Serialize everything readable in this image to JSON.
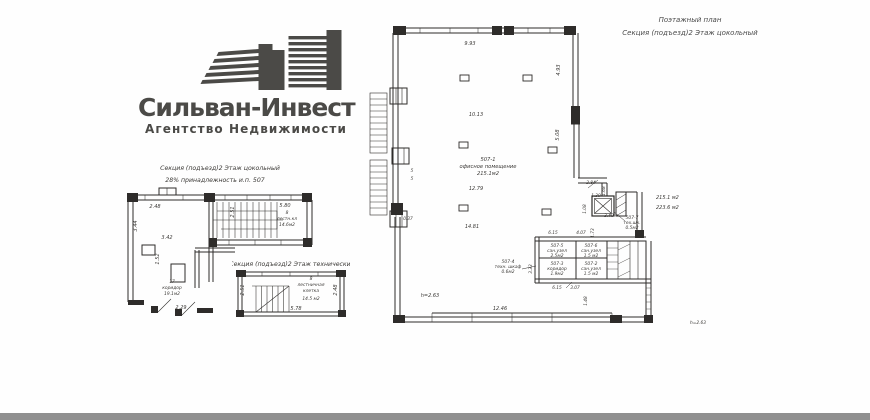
{
  "logo": {
    "title": "Сильван-Инвест",
    "subtitle": "Агентство Недвижимости"
  },
  "sheet_title": {
    "line1": "Поэтажный план",
    "line2": "Секция (подъезд)2  Этаж цокольный"
  },
  "plan_basement": {
    "header1": "Секция (подъезд)2  Этаж цокольный",
    "header2": "28% принадлежность и.п. 507",
    "stair_num": "8",
    "stair_name": "лестн.кл",
    "stair_area": "14.6м2",
    "corridor_num": "17",
    "corridor_name": "коридор",
    "corridor_area": "19.1м2",
    "d_248": "2.48",
    "d_251": "2.51",
    "d_580": "5.80",
    "d_344": "3.44",
    "d_342": "3.42",
    "d_152": "1.52",
    "d_229": "2.29"
  },
  "plan_technical": {
    "header": "Секция (подъезд)2  Этаж технический",
    "room_num": "8",
    "room_name1": "лестничная",
    "room_name2": "клетка",
    "room_area": "14.5 м2",
    "d_251": "2.51",
    "d_248": "2.48",
    "d_578": "5.78"
  },
  "plan_main": {
    "office_num": "507-1",
    "office_name": "офисное помещение",
    "office_area": "215.1м2",
    "note_area1": "215.1 м2",
    "note_area2": "223.6 м2",
    "r507_7_num": "507-7",
    "r507_7_name": "тех.шк.",
    "r507_7_area": "0.5м2",
    "r507_4_num": "507-4",
    "r507_4_name": "техн. шкаф",
    "r507_4_area": "0.6м2",
    "r507_5_num": "507-5",
    "r507_5_name": "сан.узел",
    "r507_5_area": "2.5м2",
    "r507_6_num": "507-6",
    "r507_6_name": "сан.узел",
    "r507_6_area": "1.5 м2",
    "r507_3_num": "507-3",
    "r507_3_name": "коридор",
    "r507_3_area": "1.9м2",
    "r507_2_num": "507-2",
    "r507_2_name": "сан.узел",
    "r507_2_area": "1.5 м2",
    "d_993": "9.93",
    "d_493": "4.93",
    "d_1013": "10.13",
    "d_508": "5.08",
    "d_1279": "12.79",
    "d_1481": "14.81",
    "d_284": "2.84",
    "d_139": "1.39",
    "d_168": "1.68",
    "d_108": "1.08",
    "d_340": "3.40",
    "d_173": "1.73",
    "d_615a": "6.15",
    "d_407": "4.07",
    "d_333": "3.33",
    "d_615b": "6.15",
    "d_307": "3.07",
    "d_1246": "12.46",
    "d_148": "1.48",
    "d_037": "0.37",
    "h_note": "h=2.63",
    "grid_a": "5",
    "grid_b": "5"
  },
  "footer": {
    "h_note": "h=2.63"
  }
}
